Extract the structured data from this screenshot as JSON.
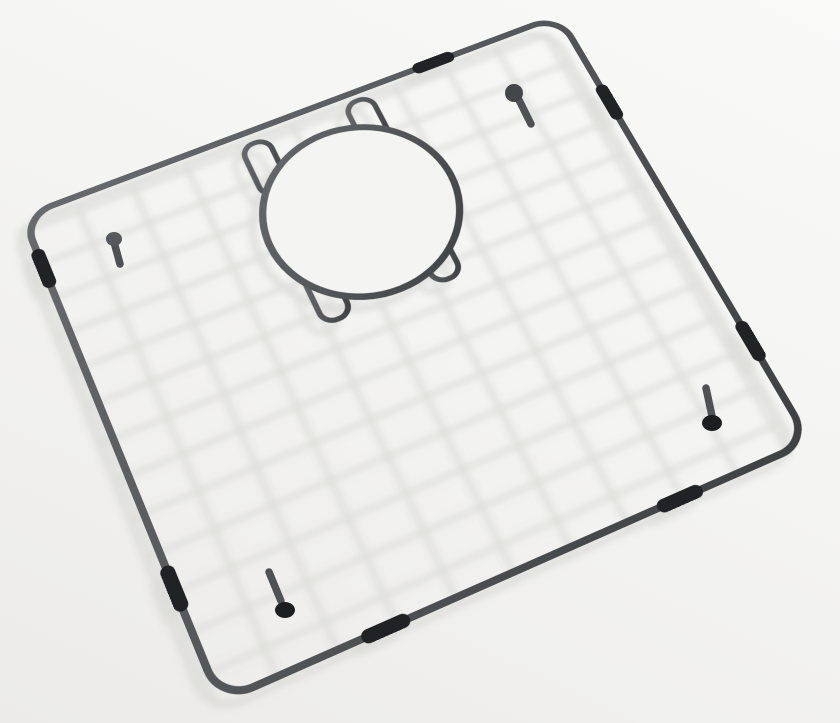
{
  "scene": {
    "type": "product-photo",
    "subject": "black stainless steel kitchen sink bottom grid with round drain opening, protective rubber bumpers and feet, photographed at an angle on a white backdrop",
    "background_top": "#f9f9f8",
    "background_bottom": "#ecebe9",
    "photo_shadow_color": "#d9d9d6"
  },
  "grid": {
    "flat_width": 580,
    "flat_height": 530,
    "corner_radius": 30,
    "frame_inset": 3.5,
    "frame_stroke_width": 7,
    "steep_wire_width": 5.5,
    "shallow_wire_width": 5,
    "wire_margin": 8,
    "wire_gradient_light": "#676a6e",
    "wire_gradient_dark": "#3e4144",
    "matrix3d": "matrix3d(0.9996,-0.3486,0,0.000116293,0.32762,0.76698,0,-0.000228189,0,0,1,0,18,215,0,1)",
    "shadow_matrix3d": "matrix3d(0.9996,-0.3486,0,0.000116293,0.32762,0.76698,0,-0.000228189,0,0,1,0,8,227,0,1)",
    "steep_wires_u": [
      12,
      68,
      124,
      180,
      236,
      292,
      348,
      404,
      460,
      516,
      568
    ],
    "shallow_wires_v": [
      12,
      52,
      92,
      132,
      172,
      212,
      252,
      292,
      332,
      372,
      412,
      452,
      492
    ]
  },
  "drain_opening": {
    "cx": 302,
    "cy": 132,
    "ring_radius": 95,
    "disc_radius": 92,
    "ring_stroke_width": 7,
    "disc_fill": "#f4f4f2",
    "tab_corner_radius": 13,
    "tab_stroke_width": 5.5,
    "connector_tabs": [
      {
        "x": 222,
        "y": 18,
        "w": 28,
        "h": 62
      },
      {
        "x": 334,
        "y": 14,
        "w": 28,
        "h": 60
      },
      {
        "x": 222,
        "y": 170,
        "w": 28,
        "h": 62
      },
      {
        "x": 334,
        "y": 172,
        "w": 28,
        "h": 64
      }
    ]
  },
  "bumpers": {
    "color": "#212225",
    "width": 13,
    "segments": [
      {
        "x1": 420,
        "y1": 3.5,
        "x2": 452,
        "y2": 3.5
      },
      {
        "x1": 576.5,
        "y1": 104,
        "x2": 576.5,
        "y2": 136
      },
      {
        "x1": 576.5,
        "y1": 398,
        "x2": 576.5,
        "y2": 430
      },
      {
        "x1": 3.5,
        "y1": 50,
        "x2": 3.5,
        "y2": 82
      },
      {
        "x1": 3.5,
        "y1": 400,
        "x2": 3.5,
        "y2": 432
      },
      {
        "x1": 140,
        "y1": 526.5,
        "x2": 172,
        "y2": 526.5
      },
      {
        "x1": 427,
        "y1": 526.5,
        "x2": 459,
        "y2": 526.5
      }
    ]
  },
  "feet": {
    "stem_color": "#4e5155",
    "stem_width": 7.5,
    "items": [
      {
        "name": "foot-upper-left",
        "stem": {
          "x1": 120,
          "y1": 264,
          "x2": 114,
          "y2": 242
        },
        "cap": {
          "cx": 114,
          "cy": 239,
          "rx": 8,
          "ry": 7
        },
        "cap_fill": "#55585c"
      },
      {
        "name": "foot-top",
        "stem": {
          "x1": 531,
          "y1": 124,
          "x2": 518,
          "y2": 98
        },
        "cap": {
          "cx": 514,
          "cy": 93,
          "rx": 9,
          "ry": 9
        },
        "cap_fill": "#44464a"
      },
      {
        "name": "foot-bottom-left",
        "stem": {
          "x1": 269,
          "y1": 572,
          "x2": 281,
          "y2": 601
        },
        "cap": {
          "cx": 285,
          "cy": 610,
          "rx": 10,
          "ry": 8
        },
        "cap_fill": "#1d1e20"
      },
      {
        "name": "foot-right",
        "stem": {
          "x1": 706,
          "y1": 388,
          "x2": 712,
          "y2": 416
        },
        "cap": {
          "cx": 712,
          "cy": 423,
          "rx": 10,
          "ry": 8
        },
        "cap_fill": "#1d1e20"
      }
    ]
  }
}
